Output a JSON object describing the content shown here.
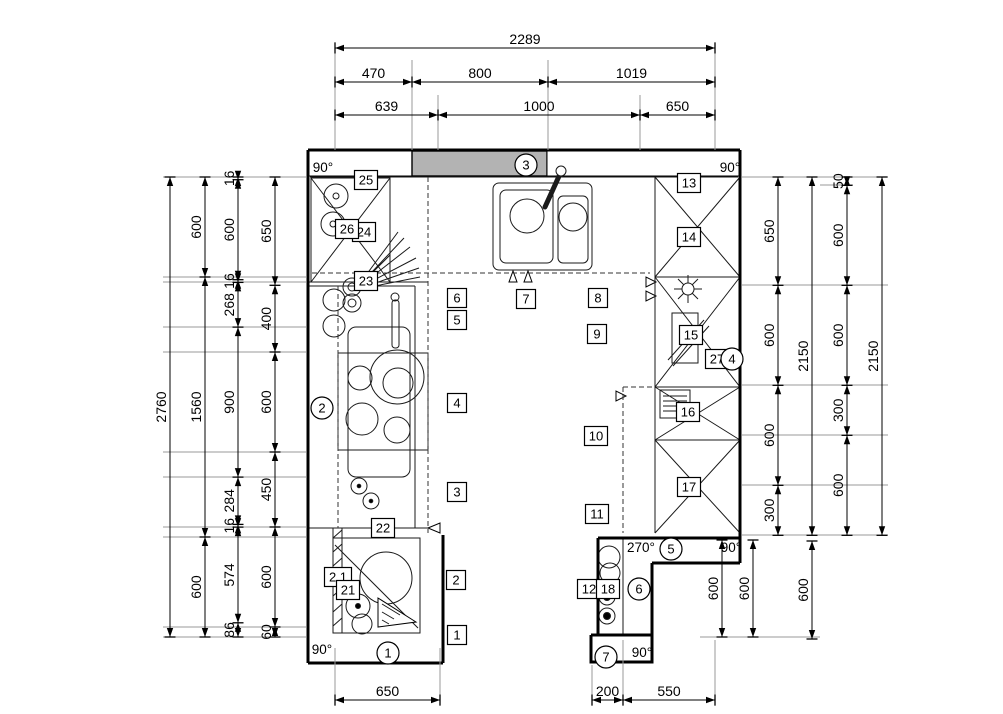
{
  "drawing": {
    "kind": "kitchen-floor-plan",
    "accent_fill": "#b3b3b3",
    "line_color": "#000000"
  },
  "dims": {
    "top": [
      {
        "values": [
          "2289"
        ]
      },
      {
        "values": [
          "470",
          "800",
          "1019"
        ]
      },
      {
        "values": [
          "639",
          "1000",
          "650"
        ]
      }
    ],
    "left": [
      {
        "values": [
          "2760"
        ]
      },
      {
        "values": [
          "600",
          "1560",
          "600"
        ]
      },
      {
        "values": [
          "16",
          "600",
          "16",
          "268",
          "900",
          "284",
          "16",
          "574",
          "86"
        ]
      },
      {
        "values": [
          "650",
          "400",
          "600",
          "450",
          "600",
          "60"
        ]
      }
    ],
    "right": [
      {
        "values": [
          "650",
          "600",
          "600",
          "300"
        ]
      },
      {
        "values": [
          "2150"
        ]
      },
      {
        "values": [
          "50",
          "600",
          "600",
          "300",
          "600"
        ]
      },
      {
        "values": [
          "2150"
        ]
      }
    ],
    "below_right": [
      {
        "values": [
          "600"
        ]
      },
      {
        "values": [
          "600"
        ]
      },
      {
        "values": [
          "600"
        ]
      }
    ],
    "bottom_left": {
      "values": [
        "650"
      ]
    },
    "bottom_right": {
      "values": [
        "200",
        "550"
      ]
    }
  },
  "callouts": {
    "boxed": [
      "1",
      "2",
      "2.1",
      "3",
      "4",
      "5",
      "6",
      "7",
      "8",
      "9",
      "10",
      "11",
      "12",
      "13",
      "14",
      "15",
      "16",
      "17",
      "18",
      "21",
      "22",
      "23",
      "24",
      "25",
      "26",
      "27"
    ],
    "circled": [
      "1",
      "2",
      "3",
      "4",
      "5",
      "6",
      "7"
    ],
    "angles": [
      "90°",
      "90°",
      "90°",
      "90°",
      "90°",
      "270°"
    ]
  }
}
